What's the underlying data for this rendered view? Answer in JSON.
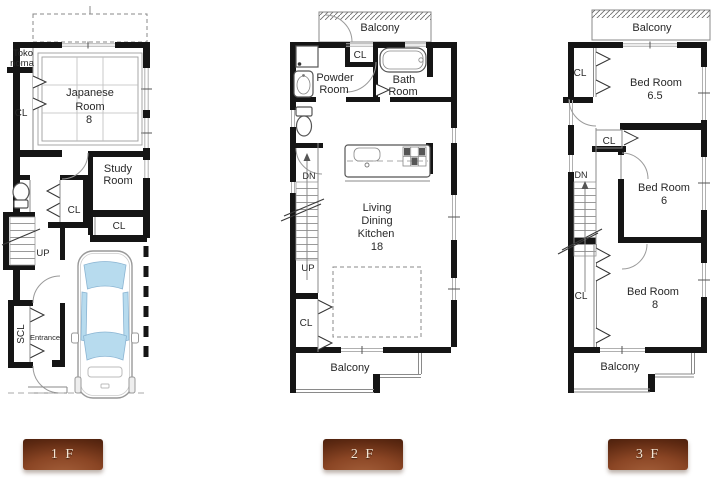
{
  "floor1": {
    "label": "1 F",
    "tokonoma": {
      "l1": "Toko",
      "l2": "noma"
    },
    "japanese_room": {
      "l1": "Japanese",
      "l2": "Room",
      "size": "8"
    },
    "cl_left": "CL",
    "study_room": {
      "l1": "Study",
      "l2": "Room"
    },
    "cl_center": "CL",
    "cl_study": "CL",
    "up": "UP",
    "scl": "SCL",
    "entrance": "Entrance"
  },
  "floor2": {
    "label": "2 F",
    "balcony_top": "Balcony",
    "cl_top": "CL",
    "powder_room": {
      "l1": "Powder",
      "l2": "Room"
    },
    "bath_room": {
      "l1": "Bath",
      "l2": "Room"
    },
    "dn": "DN",
    "up": "UP",
    "ldk": {
      "l1": "Living",
      "l2": "Dining",
      "l3": "Kitchen",
      "size": "18"
    },
    "cl_bottom": "CL",
    "balcony_bottom": "Balcony"
  },
  "floor3": {
    "label": "3 F",
    "balcony_top": "Balcony",
    "cl_top": "CL",
    "bedroom_65": {
      "l1": "Bed Room",
      "size": "6.5"
    },
    "cl_mid": "CL",
    "dn": "DN",
    "bedroom_6": {
      "l1": "Bed Room",
      "size": "6"
    },
    "cl_bottom": "CL",
    "bedroom_8": {
      "l1": "Bed Room",
      "size": "8"
    },
    "balcony_bottom": "Balcony"
  },
  "colors": {
    "wall": "#151515",
    "car_glass": "#b7dbee",
    "plaque_dark": "#3f1a0a",
    "plaque_mid": "#8a4524",
    "plaque_light": "#a5613c",
    "plaque_text": "#f3e6d5"
  }
}
